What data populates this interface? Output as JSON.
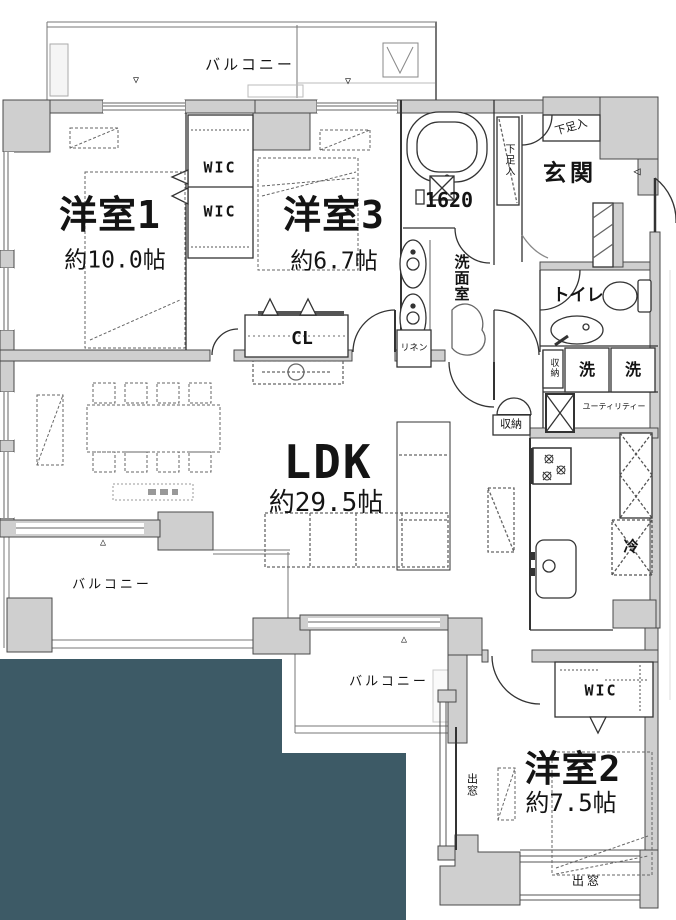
{
  "colors": {
    "background": "#ffffff",
    "wall_fill": "#cfcfcf",
    "line": "#333333",
    "accent_teal": "#3d5a66"
  },
  "rooms": {
    "room1": {
      "name": "洋室1",
      "size": "約10.0帖"
    },
    "room3": {
      "name": "洋室3",
      "size": "約6.7帖"
    },
    "ldk": {
      "name": "LDK",
      "size": "約29.5帖"
    },
    "room2": {
      "name": "洋室2",
      "size": "約7.5帖"
    }
  },
  "labels": {
    "balcony_top": "バルコニー",
    "balcony_left": "バルコニー",
    "balcony_bottom": "バルコニー",
    "wic_upper": "WIC",
    "wic_lower": "WIC",
    "wic_room2": "WIC",
    "closet_cl": "CL",
    "entrance": "玄関",
    "shoe_cabinet_top": "下足入",
    "shoe_cabinet_tall": "下足入",
    "bath_size": "1620",
    "washroom": "洗面室",
    "linen": "リネン",
    "toilet": "トイレ",
    "storage_hall": "収納",
    "storage_ldk": "収納",
    "washer_left": "洗",
    "washer_right": "洗",
    "utility": "ユーティリティー",
    "fridge": "冷",
    "bay_window_side": "出窓",
    "bay_window_bottom": "出窓"
  },
  "markers": {
    "vent_top_left": "▽",
    "vent_top_right": "▽",
    "vent_balcony_left": "△",
    "vent_balcony_bottom": "△",
    "entry_door": "◁"
  }
}
